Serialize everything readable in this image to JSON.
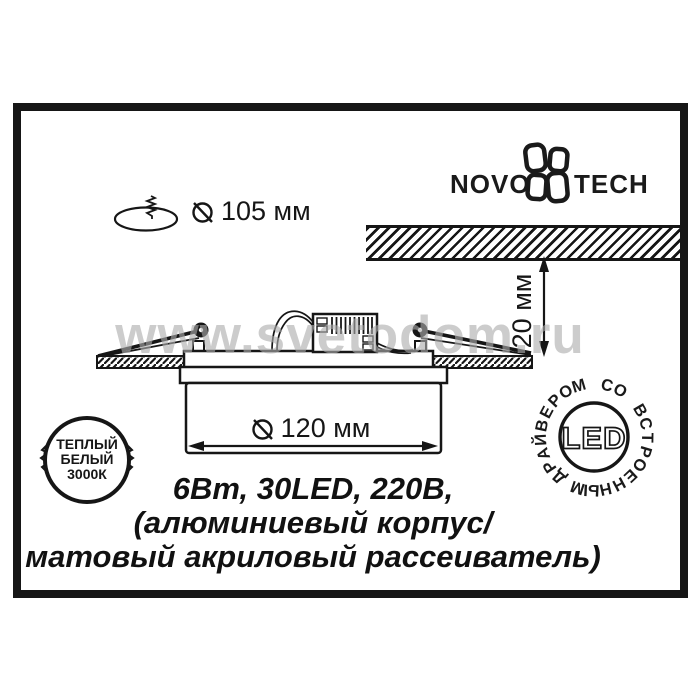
{
  "logo": {
    "part1": "NOVO",
    "part2": "TECH"
  },
  "cutout_dimension": {
    "value": "105 мм"
  },
  "recess_dimension": {
    "value": "20 мм"
  },
  "diameter_dimension": {
    "value": "120 мм"
  },
  "badge": {
    "line1": "ТЕПЛЫЙ",
    "line2": "БЕЛЫЙ",
    "line3": "3000К"
  },
  "stamp": {
    "center_label": "LED",
    "circular_text": "ДРАЙВЕРОМ СО ВСТРОЕННЫМ"
  },
  "specs": {
    "line1": "6Вт, 30LED, 220В,",
    "line2": "(алюминиевый корпус/",
    "line3": "матовый акриловый рассеиватель)"
  },
  "watermark": {
    "text": "www.svetodom.ru"
  },
  "colors": {
    "ink": "#161616",
    "watermark_gray": "#acacac",
    "background": "#ffffff"
  }
}
